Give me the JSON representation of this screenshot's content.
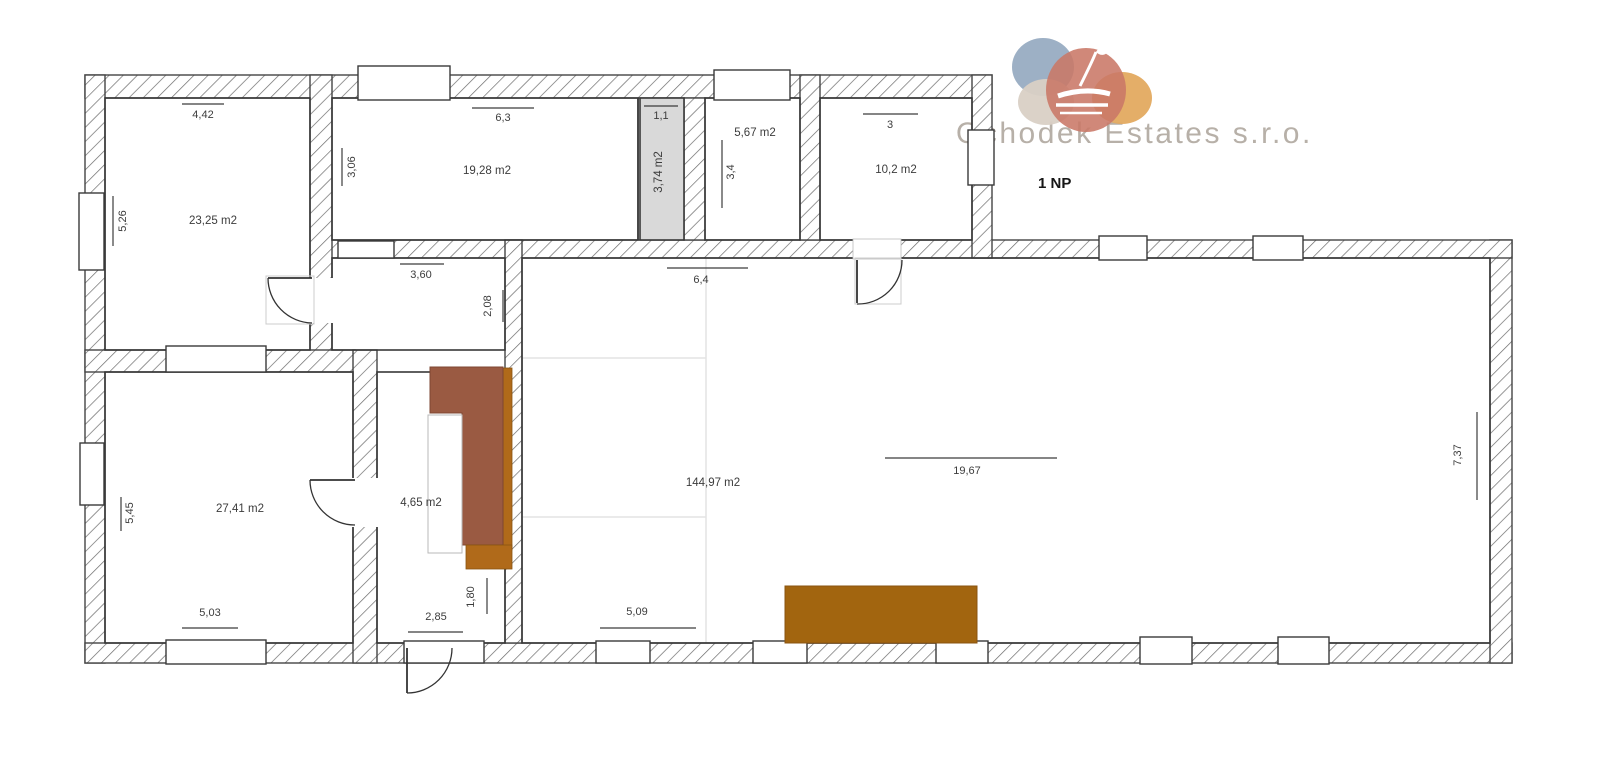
{
  "logo": {
    "company": "Ochodek Estates s.r.o.",
    "floor_label": "1 NP"
  },
  "plan": {
    "rooms": [
      {
        "name": "room-top-left",
        "area": "23,25 m2",
        "dim_top": "4,42",
        "dim_left": "5,26"
      },
      {
        "name": "room-top-middle",
        "area": "19,28 m2",
        "dim_top": "6,3",
        "dim_left": "3,06"
      },
      {
        "name": "room-utility",
        "area": "3,74 m2",
        "dim_top": "1,1"
      },
      {
        "name": "room-small",
        "area": "5,67 m2",
        "dim_left": "3,4"
      },
      {
        "name": "room-top-right",
        "area": "10,2 m2",
        "dim_top": "3"
      },
      {
        "name": "room-hall",
        "dim_top": "3,60",
        "dim_right": "2,08"
      },
      {
        "name": "room-bottom-left",
        "area": "27,41 m2",
        "dim_left": "5,45",
        "dim_bottom": "5,03"
      },
      {
        "name": "room-stairs",
        "area": "4,65 m2",
        "dim_right": "1,80",
        "dim_bottom": "2,85"
      },
      {
        "name": "room-main",
        "area": "144,97 m2",
        "dim_top": "6,4",
        "dim_mid": "19,67",
        "dim_bottom": "5,09",
        "dim_right": "7,37"
      }
    ]
  },
  "colors": {
    "stair_brown": "#9a5a42",
    "cabinet_orange": "#b06a1a",
    "counter_brown": "#a2650f",
    "utility_fill": "#d9d9d9",
    "logo_blue": "#92a7bf",
    "logo_beige": "#d9d0c5",
    "logo_orange": "#e3aa60",
    "logo_salmon": "#c97766",
    "logo_text_color": "#b7b0a8"
  }
}
